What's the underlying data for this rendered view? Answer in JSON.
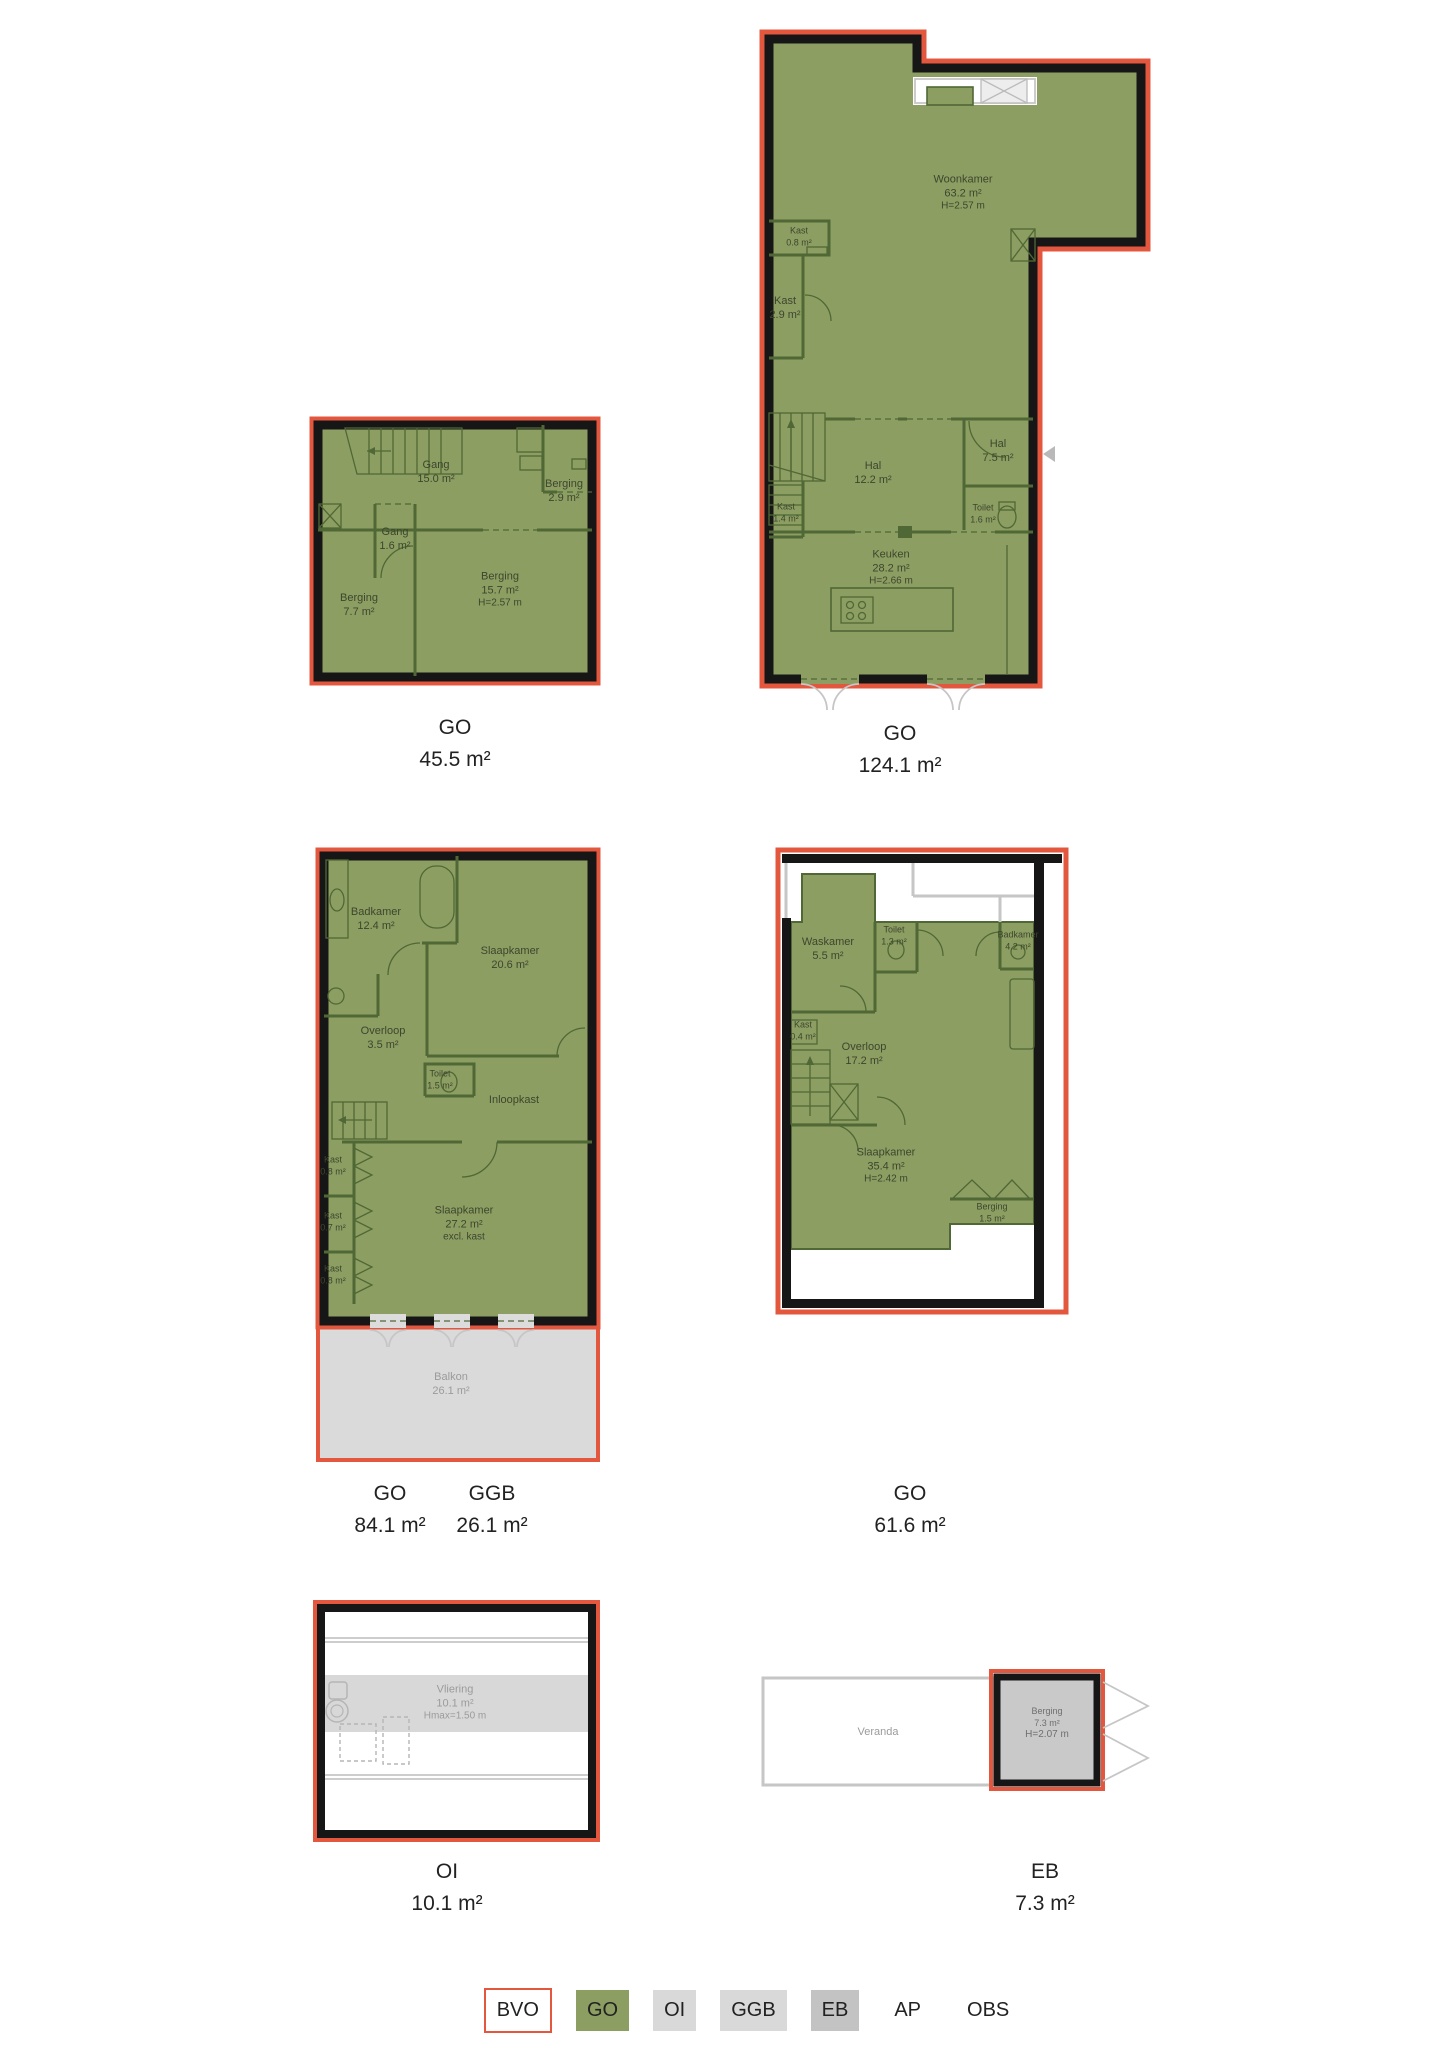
{
  "colors": {
    "go_green": "#8d9e63",
    "outline_red": "#e4573f",
    "ggb_gray": "#d9d9d9",
    "eb_gray": "#c3c3c3",
    "wall_black": "#161616"
  },
  "plans": [
    {
      "label": {
        "code": "GO",
        "area": "45.5 m²"
      },
      "rooms": {
        "gang15": {
          "name": "Gang",
          "area": "15.0 m²"
        },
        "berging29": {
          "name": "Berging",
          "area": "2.9 m²"
        },
        "gang16": {
          "name": "Gang",
          "area": "1.6 m²"
        },
        "berging77": {
          "name": "Berging",
          "area": "7.7 m²"
        },
        "berging157": {
          "name": "Berging",
          "area": "15.7 m²",
          "height": "H=2.57 m"
        }
      }
    },
    {
      "label": {
        "code": "GO",
        "area": "124.1 m²"
      },
      "rooms": {
        "woonkamer": {
          "name": "Woonkamer",
          "area": "63.2 m²",
          "height": "H=2.57 m"
        },
        "kast08": {
          "name": "Kast",
          "area": "0.8 m²"
        },
        "kast29": {
          "name": "Kast",
          "area": "2.9 m²"
        },
        "hal122": {
          "name": "Hal",
          "area": "12.2 m²"
        },
        "hal75": {
          "name": "Hal",
          "area": "7.5 m²"
        },
        "toilet16": {
          "name": "Toilet",
          "area": "1.6 m²"
        },
        "kast14": {
          "name": "Kast",
          "area": "1.4 m²"
        },
        "keuken": {
          "name": "Keuken",
          "area": "28.2 m²",
          "height": "H=2.66 m"
        }
      }
    },
    {
      "label": {
        "code": "GO",
        "area": "84.1 m²"
      },
      "label2": {
        "code": "GGB",
        "area": "26.1 m²"
      },
      "rooms": {
        "badkamer": {
          "name": "Badkamer",
          "area": "12.4 m²"
        },
        "slaapkamer1": {
          "name": "Slaapkamer",
          "area": "20.6 m²"
        },
        "overloop": {
          "name": "Overloop",
          "area": "3.5 m²"
        },
        "toilet": {
          "name": "Toilet",
          "area": "1.5 m²"
        },
        "inloopkast": {
          "name": "Inloopkast"
        },
        "kastA": {
          "name": "Kast",
          "area": "0.8 m²"
        },
        "kastB": {
          "name": "Kast",
          "area": "0.7 m²"
        },
        "kastC": {
          "name": "Kast",
          "area": "0.8 m²"
        },
        "slaapkamer2": {
          "name": "Slaapkamer",
          "area": "27.2 m²",
          "note": "excl. kast"
        },
        "balkon": {
          "name": "Balkon",
          "area": "26.1 m²"
        }
      }
    },
    {
      "label": {
        "code": "GO",
        "area": "61.6 m²"
      },
      "rooms": {
        "waskamer": {
          "name": "Waskamer",
          "area": "5.5 m²"
        },
        "toilet": {
          "name": "Toilet",
          "area": "1.3 m²"
        },
        "badkamer": {
          "name": "Badkamer",
          "area": "4.2 m²"
        },
        "kast": {
          "name": "Kast",
          "area": "0.4 m²"
        },
        "overloop": {
          "name": "Overloop",
          "area": "17.2 m²"
        },
        "slaapkamer": {
          "name": "Slaapkamer",
          "area": "35.4 m²",
          "height": "H=2.42 m"
        },
        "berging": {
          "name": "Berging",
          "area": "1.5 m²"
        }
      }
    },
    {
      "label": {
        "code": "OI",
        "area": "10.1 m²"
      },
      "rooms": {
        "vliering": {
          "name": "Vliering",
          "area": "10.1 m²",
          "height": "Hmax=1.50 m"
        }
      }
    },
    {
      "label": {
        "code": "EB",
        "area": "7.3 m²"
      },
      "rooms": {
        "veranda": {
          "name": "Veranda"
        },
        "berging": {
          "name": "Berging",
          "area": "7.3 m²",
          "height": "H=2.07 m"
        }
      }
    }
  ],
  "legend": {
    "items": [
      {
        "label": "BVO"
      },
      {
        "label": "GO"
      },
      {
        "label": "OI"
      },
      {
        "label": "GGB"
      },
      {
        "label": "EB"
      },
      {
        "label": "AP"
      },
      {
        "label": "OBS"
      }
    ]
  }
}
